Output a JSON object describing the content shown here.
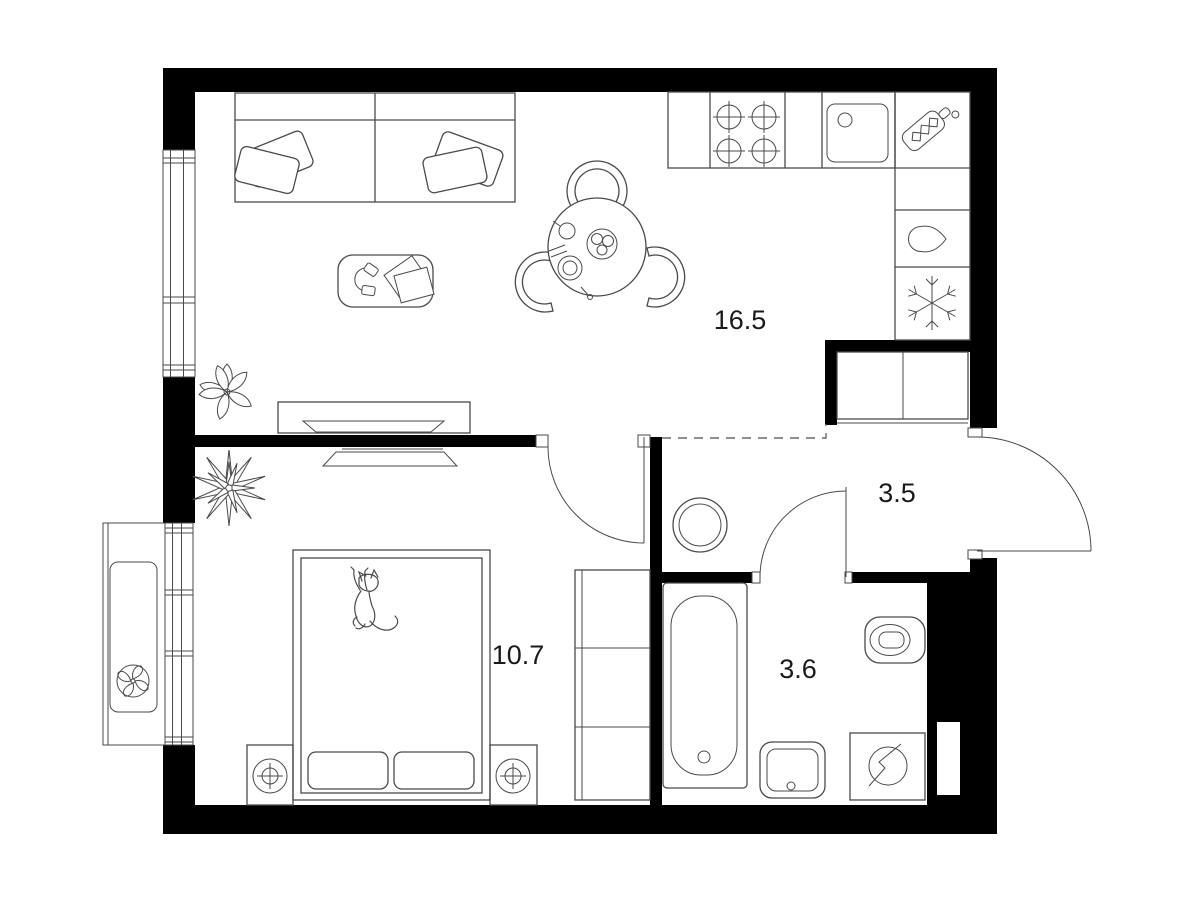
{
  "floor_plan": {
    "type": "apartment-floor-plan",
    "background_color": "#ffffff",
    "wall_color": "#000000",
    "outline_color": "#4a4a4a",
    "text_color": "#1a1a1a",
    "rooms": [
      {
        "id": "living-room-kitchen",
        "area_label": "16.5"
      },
      {
        "id": "bedroom",
        "area_label": "10.7"
      },
      {
        "id": "hallway",
        "area_label": "3.5"
      },
      {
        "id": "bathroom",
        "area_label": "3.6"
      }
    ],
    "fixtures": [
      "sofa-with-pillows",
      "coffee-table",
      "headphones",
      "books",
      "round-dining-table",
      "three-chairs",
      "table-setting",
      "kitchen-counter",
      "hob-4-burners",
      "kitchen-sink",
      "cutting-board",
      "tall-cabinet-column",
      "water-drop-cell",
      "snowflake-freezer-cell",
      "hallway-wardrobe",
      "round-pouf",
      "tv-console-double-tv",
      "double-bed",
      "cat-on-bed",
      "nightstand-lamps",
      "bedroom-closet",
      "flower-plant",
      "spiky-plant",
      "balcony",
      "air-conditioner-fan",
      "bathtub",
      "washbasin",
      "washing-machine",
      "toilet"
    ]
  }
}
